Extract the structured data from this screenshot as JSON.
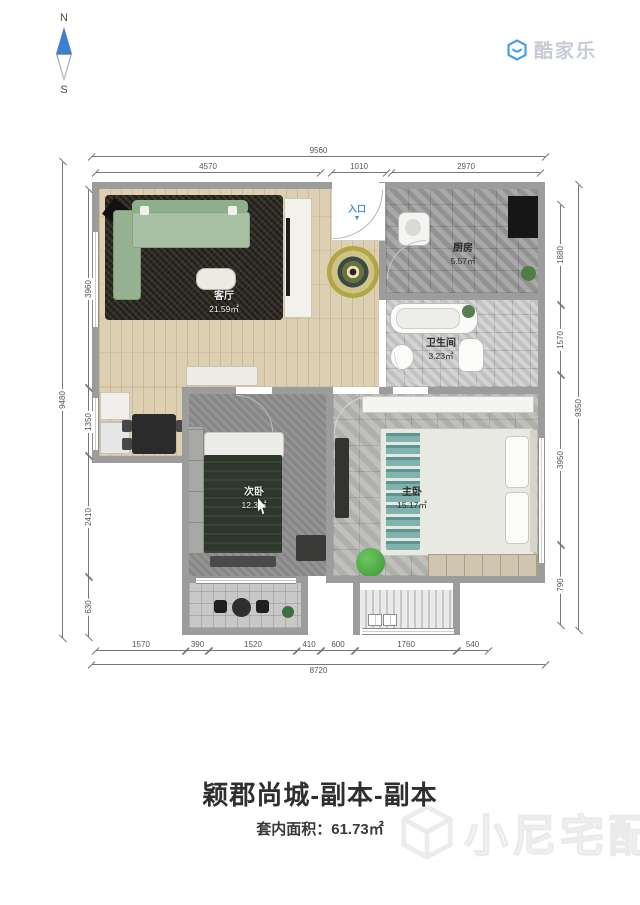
{
  "compass": {
    "north": "N",
    "south": "S"
  },
  "logo": {
    "name": "酷家乐"
  },
  "entry": {
    "label": "入口",
    "arrow": "▼"
  },
  "rooms": {
    "living": {
      "name": "客厅",
      "area": "21.59㎡"
    },
    "kitchen": {
      "name": "厨房",
      "area": "5.57㎡"
    },
    "bathroom": {
      "name": "卫生间",
      "area": "3.23㎡"
    },
    "bedroom2": {
      "name": "次卧",
      "area": "12.3㎡"
    },
    "master": {
      "name": "主卧",
      "area": "15.17㎡"
    }
  },
  "dimensions": {
    "top_total": "9560",
    "top": [
      "4570",
      "1010",
      "2970"
    ],
    "bottom": [
      "1570",
      "390",
      "1520",
      "410",
      "600",
      "1760",
      "540"
    ],
    "bottom_total": "8720",
    "left": [
      "3960",
      "1350",
      "2410",
      "630"
    ],
    "left_total": "9480",
    "right": [
      "1880",
      "1570",
      "3950",
      "790"
    ],
    "right_total": "9350"
  },
  "footer": {
    "title": "颖郡尚城-副本-副本",
    "area_label": "套内面积：",
    "area_value": "61.73㎡"
  },
  "watermark": {
    "name": "小尼宅配"
  },
  "colors": {
    "accent_blue": "#3D8FD6",
    "logo_blue": "#4AA0E8",
    "wall_gray": "#9C9C9C",
    "title_text": "#2F2F2F",
    "sofa_green": "#9FB89B",
    "beanbag_green": "#55B04A"
  }
}
